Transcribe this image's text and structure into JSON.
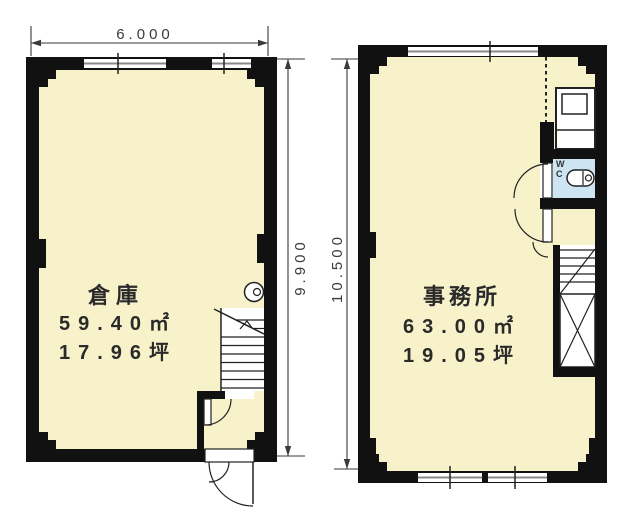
{
  "left_plan": {
    "name": "倉庫",
    "area_m2": "59.40㎡",
    "area_tsubo": "17.96坪",
    "width_dim": "6.000",
    "height_dim": "9.900"
  },
  "right_plan": {
    "name": "事務所",
    "area_m2": "63.00㎡",
    "area_tsubo": "19.05坪",
    "height_dim": "10.500",
    "wc_label": "WC"
  },
  "colors": {
    "floor": "#f7f2c9",
    "wall": "#111111",
    "wc_floor": "#cde4f2",
    "line": "#222222",
    "dim": "#3a3a3a",
    "window_line": "#8a8a8a"
  }
}
